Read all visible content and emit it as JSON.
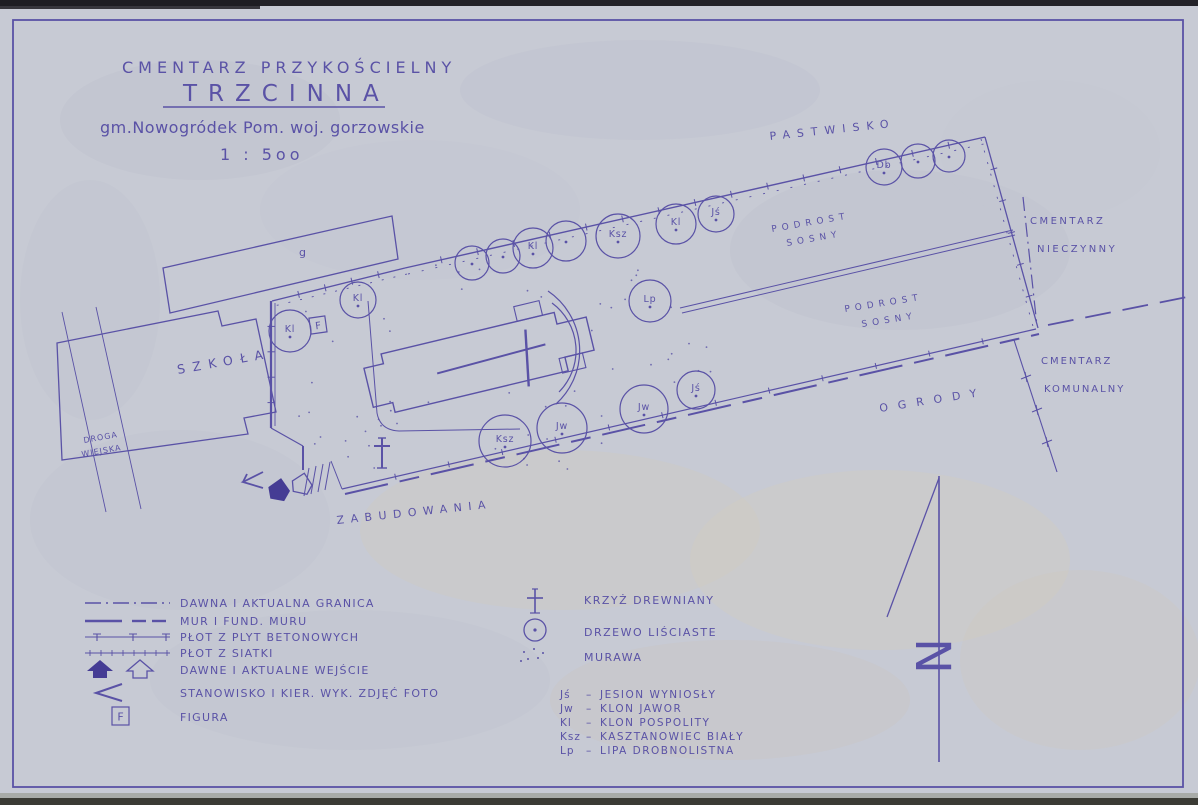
{
  "colors": {
    "paper": "#c7cad4",
    "ink": "#5a52a6",
    "ink_dark": "#453c94",
    "photo_edge_top": "#232228",
    "photo_edge_bottom": "#3b3b35"
  },
  "title": {
    "line1": "CMENTARZ  PRZYKOŚCIELNY",
    "line2": "TRZCINNA",
    "line3": "gm.Nowogródek Pom. woj. gorzowskie",
    "scale": "1 : 5oo"
  },
  "map": {
    "figure_letter": "F",
    "labels": {
      "pastwisko": "PASTWISKO",
      "building_g": "g",
      "szkola": "SZKOŁA",
      "droga_line1": "DROGA",
      "droga_line2": "WIEJSKA",
      "zabudowania": "ZABUDOWANIA",
      "podrost_line1": "PODROST",
      "podrost_line2": "SOSNY",
      "ogrody": "OGRODY",
      "nieczynny_line1": "CMENTARZ",
      "nieczynny_line2": "NIECZYNNY",
      "komunalny_line1": "CMENTARZ",
      "komunalny_line2": "KOMUNALNY"
    },
    "trees": [
      {
        "x": 472,
        "y": 263,
        "r": 17,
        "label": ""
      },
      {
        "x": 503,
        "y": 256,
        "r": 17,
        "label": ""
      },
      {
        "x": 533,
        "y": 248,
        "r": 20,
        "label": "Kl"
      },
      {
        "x": 566,
        "y": 241,
        "r": 20,
        "label": ""
      },
      {
        "x": 618,
        "y": 236,
        "r": 22,
        "label": "Ksz"
      },
      {
        "x": 676,
        "y": 224,
        "r": 20,
        "label": "Kl"
      },
      {
        "x": 716,
        "y": 214,
        "r": 18,
        "label": "Jś"
      },
      {
        "x": 884,
        "y": 167,
        "r": 18,
        "label": "Db"
      },
      {
        "x": 918,
        "y": 161,
        "r": 17,
        "label": ""
      },
      {
        "x": 949,
        "y": 156,
        "r": 16,
        "label": ""
      },
      {
        "x": 290,
        "y": 331,
        "r": 21,
        "label": "Kl"
      },
      {
        "x": 358,
        "y": 300,
        "r": 18,
        "label": "Kl"
      },
      {
        "x": 650,
        "y": 301,
        "r": 21,
        "label": "Lp"
      },
      {
        "x": 562,
        "y": 428,
        "r": 25,
        "label": "Jw"
      },
      {
        "x": 644,
        "y": 409,
        "r": 24,
        "label": "Jw"
      },
      {
        "x": 696,
        "y": 390,
        "r": 19,
        "label": "Jś"
      },
      {
        "x": 505,
        "y": 441,
        "r": 26,
        "label": "Ksz"
      }
    ]
  },
  "legend": {
    "left_rows": [
      {
        "symbol": "boundary-line",
        "label": "DAWNA  I  AKTUALNA  GRANICA"
      },
      {
        "symbol": "wall-line",
        "label": "MUR  I  FUND. MURU"
      },
      {
        "symbol": "concrete-slab-fence-line",
        "label": "PŁOT  Z  PLYT  BETONOWYCH"
      },
      {
        "symbol": "mesh-fence-line",
        "label": "PŁOT  Z  SIATKI"
      },
      {
        "symbol": "entrance-icons",
        "label": "DAWNE  I  AKTUALNE  WEJŚCIE"
      },
      {
        "symbol": "photo-direction",
        "label": "STANOWISKO  I  KIER. WYK. ZDJĘĆ  FOTO"
      },
      {
        "symbol": "figure-box",
        "label": "FIGURA"
      }
    ],
    "mid_rows": [
      {
        "symbol": "wooden-cross",
        "label": "KRZYŻ  DREWNIANY"
      },
      {
        "symbol": "tree-circle",
        "label": "DRZEWO  LIŚCIASTE"
      },
      {
        "symbol": "grass-dots",
        "label": "MURAWA"
      }
    ],
    "species_dash": "–",
    "species": [
      {
        "code": "Jś",
        "name": "JESION  WYNIOSŁY"
      },
      {
        "code": "Jw",
        "name": "KLON  JAWOR"
      },
      {
        "code": "Kl",
        "name": "KLON  POSPOLITY"
      },
      {
        "code": "Ksz",
        "name": "KASZTANOWIEC  BIAŁY"
      },
      {
        "code": "Lp",
        "name": "LIPA  DROBNOLISTNA"
      }
    ]
  },
  "north_letter": "N"
}
